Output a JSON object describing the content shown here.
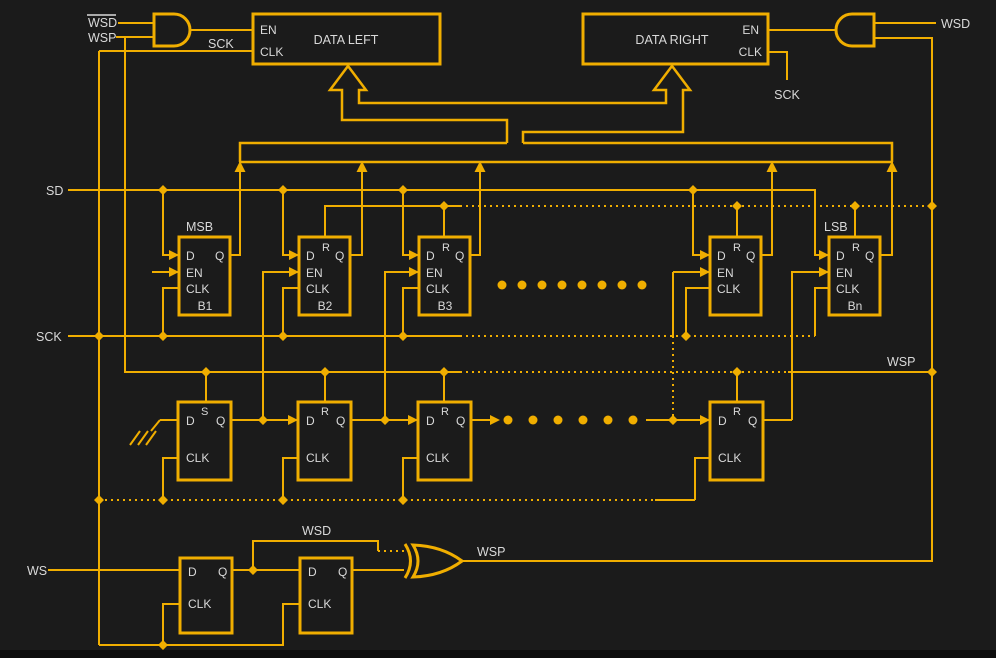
{
  "palette": {
    "background": "#1b1b1b",
    "wire": "#f0ae00",
    "label": "#d9d9d9"
  },
  "signals": {
    "wsd_inverted": "WSD",
    "wsp": "WSP",
    "sck": "SCK",
    "sd": "SD",
    "ws": "WS",
    "wsd": "WSD"
  },
  "markers": {
    "msb": "MSB",
    "lsb": "LSB"
  },
  "registers": {
    "left_title": "DATA LEFT",
    "right_title": "DATA RIGHT",
    "en": "EN",
    "clk": "CLK"
  },
  "pins": {
    "d": "D",
    "q": "Q",
    "en": "EN",
    "clk": "CLK",
    "r": "R",
    "s": "S"
  },
  "ffs": {
    "b1": "B1",
    "b2": "B2",
    "b3": "B3",
    "bn": "Bn"
  }
}
